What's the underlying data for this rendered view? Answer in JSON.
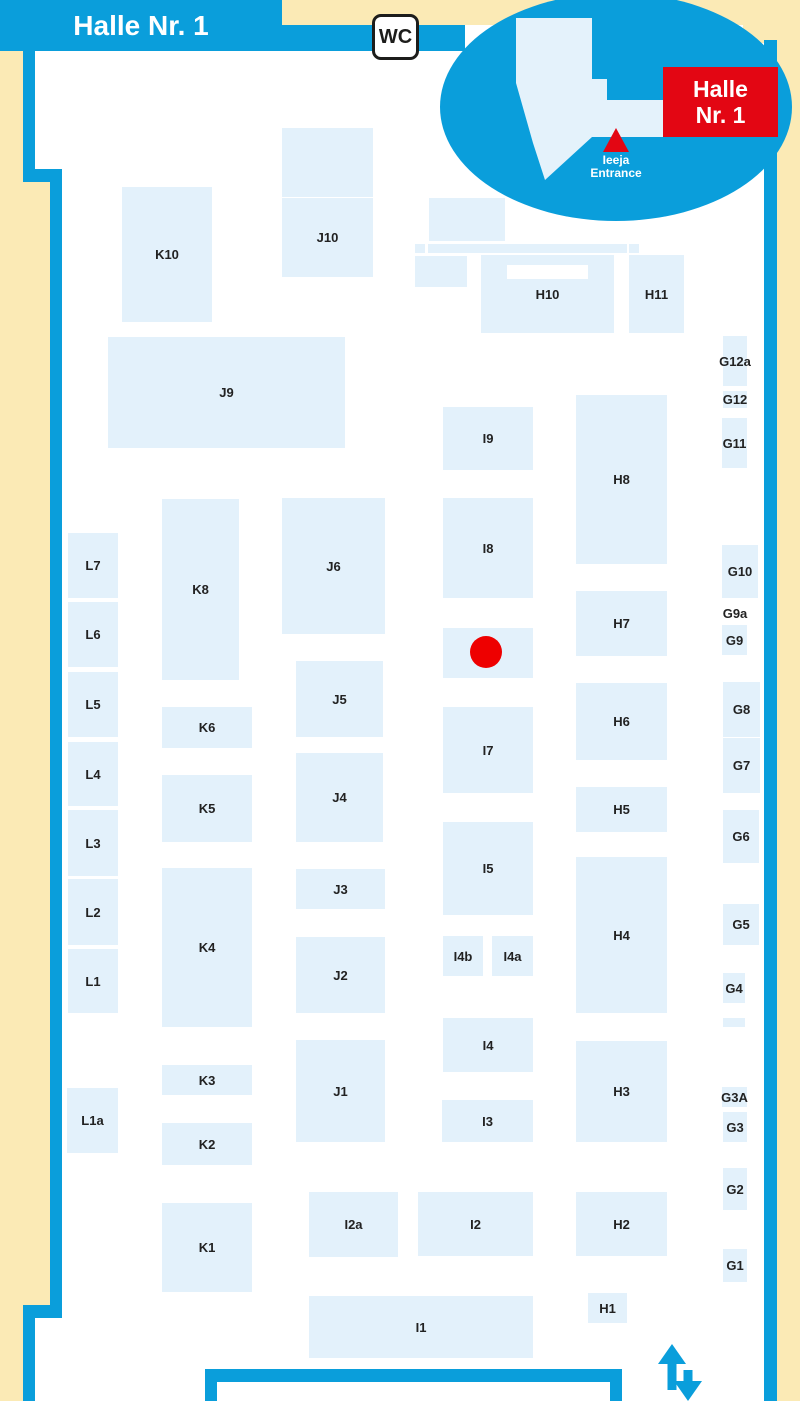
{
  "map": {
    "title": "Halle Nr. 1",
    "wc_label": "WC",
    "inset": {
      "hall_label_line1": "Halle",
      "hall_label_line2": "Nr. 1",
      "entrance_line1": "Ieeja",
      "entrance_line2": "Entrance"
    },
    "colors": {
      "wall_blue": "#0A9EDB",
      "background_sand": "#FBEAB5",
      "booth_fill": "#E3F1FB",
      "label_text": "#222222",
      "accent_red": "#E30613",
      "marker_red": "#EE0000"
    },
    "marker": {
      "x": 486,
      "y": 652,
      "r": 16
    },
    "booths": [
      {
        "id": "K10",
        "label": "K10",
        "x": 122,
        "y": 187,
        "w": 90,
        "h": 135
      },
      {
        "id": "J10-annex",
        "label": "",
        "x": 282,
        "y": 128,
        "w": 91,
        "h": 69
      },
      {
        "id": "J10",
        "label": "J10",
        "x": 282,
        "y": 198,
        "w": 91,
        "h": 79
      },
      {
        "id": "J9",
        "label": "J9",
        "x": 108,
        "y": 337,
        "w": 237,
        "h": 111
      },
      {
        "id": "area-top-1",
        "label": "",
        "x": 429,
        "y": 198,
        "w": 76,
        "h": 43
      },
      {
        "id": "strip-1",
        "label": "",
        "x": 415,
        "y": 244,
        "w": 10,
        "h": 9
      },
      {
        "id": "strip-2",
        "label": "",
        "x": 428,
        "y": 244,
        "w": 199,
        "h": 9
      },
      {
        "id": "strip-3",
        "label": "",
        "x": 629,
        "y": 244,
        "w": 10,
        "h": 9
      },
      {
        "id": "area-top-2",
        "label": "",
        "x": 415,
        "y": 256,
        "w": 52,
        "h": 31
      },
      {
        "id": "H10",
        "label": "H10",
        "x": 481,
        "y": 255,
        "w": 133,
        "h": 78,
        "notch": {
          "dx": 26,
          "dy": 10,
          "w": 81,
          "h": 14
        }
      },
      {
        "id": "H11",
        "label": "H11",
        "x": 629,
        "y": 255,
        "w": 55,
        "h": 78
      },
      {
        "id": "G12a",
        "label": "G12a",
        "x": 723,
        "y": 336,
        "w": 24,
        "h": 50
      },
      {
        "id": "G12",
        "label": "G12",
        "x": 723,
        "y": 391,
        "w": 24,
        "h": 17
      },
      {
        "id": "G11",
        "label": "G11",
        "x": 722,
        "y": 418,
        "w": 25,
        "h": 50
      },
      {
        "id": "I9",
        "label": "I9",
        "x": 443,
        "y": 407,
        "w": 90,
        "h": 63
      },
      {
        "id": "H8",
        "label": "H8",
        "x": 576,
        "y": 395,
        "w": 91,
        "h": 169
      },
      {
        "id": "L7",
        "label": "L7",
        "x": 68,
        "y": 533,
        "w": 50,
        "h": 65
      },
      {
        "id": "L6",
        "label": "L6",
        "x": 68,
        "y": 602,
        "w": 50,
        "h": 65
      },
      {
        "id": "L5",
        "label": "L5",
        "x": 68,
        "y": 672,
        "w": 50,
        "h": 65
      },
      {
        "id": "L4",
        "label": "L4",
        "x": 68,
        "y": 742,
        "w": 50,
        "h": 64
      },
      {
        "id": "L3",
        "label": "L3",
        "x": 68,
        "y": 810,
        "w": 50,
        "h": 66
      },
      {
        "id": "L2",
        "label": "L2",
        "x": 68,
        "y": 879,
        "w": 50,
        "h": 66
      },
      {
        "id": "L1",
        "label": "L1",
        "x": 68,
        "y": 949,
        "w": 50,
        "h": 64
      },
      {
        "id": "L1a",
        "label": "L1a",
        "x": 67,
        "y": 1088,
        "w": 51,
        "h": 65
      },
      {
        "id": "K8",
        "label": "K8",
        "x": 162,
        "y": 499,
        "w": 77,
        "h": 181
      },
      {
        "id": "K6",
        "label": "K6",
        "x": 162,
        "y": 707,
        "w": 90,
        "h": 41
      },
      {
        "id": "K5",
        "label": "K5",
        "x": 162,
        "y": 775,
        "w": 90,
        "h": 67
      },
      {
        "id": "K4",
        "label": "K4",
        "x": 162,
        "y": 868,
        "w": 90,
        "h": 159
      },
      {
        "id": "K3",
        "label": "K3",
        "x": 162,
        "y": 1065,
        "w": 90,
        "h": 30
      },
      {
        "id": "K2",
        "label": "K2",
        "x": 162,
        "y": 1123,
        "w": 90,
        "h": 42
      },
      {
        "id": "K1",
        "label": "K1",
        "x": 162,
        "y": 1203,
        "w": 90,
        "h": 89
      },
      {
        "id": "J6",
        "label": "J6",
        "x": 282,
        "y": 498,
        "w": 103,
        "h": 136
      },
      {
        "id": "J5",
        "label": "J5",
        "x": 296,
        "y": 661,
        "w": 87,
        "h": 76
      },
      {
        "id": "J4",
        "label": "J4",
        "x": 296,
        "y": 753,
        "w": 87,
        "h": 89
      },
      {
        "id": "J3",
        "label": "J3",
        "x": 296,
        "y": 869,
        "w": 89,
        "h": 40
      },
      {
        "id": "J2",
        "label": "J2",
        "x": 296,
        "y": 937,
        "w": 89,
        "h": 76
      },
      {
        "id": "J1",
        "label": "J1",
        "x": 296,
        "y": 1040,
        "w": 89,
        "h": 102
      },
      {
        "id": "I8",
        "label": "I8",
        "x": 443,
        "y": 498,
        "w": 90,
        "h": 100
      },
      {
        "id": "marker-area",
        "label": "",
        "x": 443,
        "y": 628,
        "w": 90,
        "h": 50
      },
      {
        "id": "I7",
        "label": "I7",
        "x": 443,
        "y": 707,
        "w": 90,
        "h": 86
      },
      {
        "id": "I5",
        "label": "I5",
        "x": 443,
        "y": 822,
        "w": 90,
        "h": 93
      },
      {
        "id": "I4b",
        "label": "I4b",
        "x": 443,
        "y": 936,
        "w": 40,
        "h": 40
      },
      {
        "id": "I4a",
        "label": "I4a",
        "x": 492,
        "y": 936,
        "w": 41,
        "h": 40
      },
      {
        "id": "I4",
        "label": "I4",
        "x": 443,
        "y": 1018,
        "w": 90,
        "h": 54
      },
      {
        "id": "I3",
        "label": "I3",
        "x": 442,
        "y": 1100,
        "w": 91,
        "h": 42
      },
      {
        "id": "I2a",
        "label": "I2a",
        "x": 309,
        "y": 1192,
        "w": 89,
        "h": 65
      },
      {
        "id": "I2",
        "label": "I2",
        "x": 418,
        "y": 1192,
        "w": 115,
        "h": 64
      },
      {
        "id": "I1",
        "label": "I1",
        "x": 309,
        "y": 1296,
        "w": 224,
        "h": 62
      },
      {
        "id": "H7",
        "label": "H7",
        "x": 576,
        "y": 591,
        "w": 91,
        "h": 65
      },
      {
        "id": "H6",
        "label": "H6",
        "x": 576,
        "y": 683,
        "w": 91,
        "h": 77
      },
      {
        "id": "H5",
        "label": "H5",
        "x": 576,
        "y": 787,
        "w": 91,
        "h": 45
      },
      {
        "id": "H4",
        "label": "H4",
        "x": 576,
        "y": 857,
        "w": 91,
        "h": 156
      },
      {
        "id": "H3",
        "label": "H3",
        "x": 576,
        "y": 1041,
        "w": 91,
        "h": 101
      },
      {
        "id": "H2",
        "label": "H2",
        "x": 576,
        "y": 1192,
        "w": 91,
        "h": 64
      },
      {
        "id": "H1",
        "label": "H1",
        "x": 588,
        "y": 1293,
        "w": 39,
        "h": 30
      },
      {
        "id": "G10",
        "label": "G10",
        "x": 722,
        "y": 545,
        "w": 36,
        "h": 53
      },
      {
        "id": "G9a",
        "label": "G9a",
        "x": 723,
        "y": 604,
        "w": 24,
        "h": 18,
        "fill": false
      },
      {
        "id": "G9",
        "label": "G9",
        "x": 722,
        "y": 625,
        "w": 25,
        "h": 30
      },
      {
        "id": "G8",
        "label": "G8",
        "x": 723,
        "y": 682,
        "w": 37,
        "h": 55
      },
      {
        "id": "G7",
        "label": "G7",
        "x": 723,
        "y": 738,
        "w": 37,
        "h": 55
      },
      {
        "id": "G6",
        "label": "G6",
        "x": 723,
        "y": 810,
        "w": 36,
        "h": 53
      },
      {
        "id": "G5",
        "label": "G5",
        "x": 723,
        "y": 904,
        "w": 36,
        "h": 41
      },
      {
        "id": "G4",
        "label": "G4",
        "x": 723,
        "y": 973,
        "w": 22,
        "h": 30
      },
      {
        "id": "strip-g4",
        "label": "",
        "x": 723,
        "y": 1018,
        "w": 22,
        "h": 9
      },
      {
        "id": "G3A",
        "label": "G3A",
        "x": 722,
        "y": 1087,
        "w": 25,
        "h": 20
      },
      {
        "id": "G3",
        "label": "G3",
        "x": 723,
        "y": 1112,
        "w": 24,
        "h": 30
      },
      {
        "id": "G2",
        "label": "G2",
        "x": 723,
        "y": 1168,
        "w": 24,
        "h": 42
      },
      {
        "id": "G1",
        "label": "G1",
        "x": 723,
        "y": 1249,
        "w": 24,
        "h": 33
      }
    ]
  }
}
